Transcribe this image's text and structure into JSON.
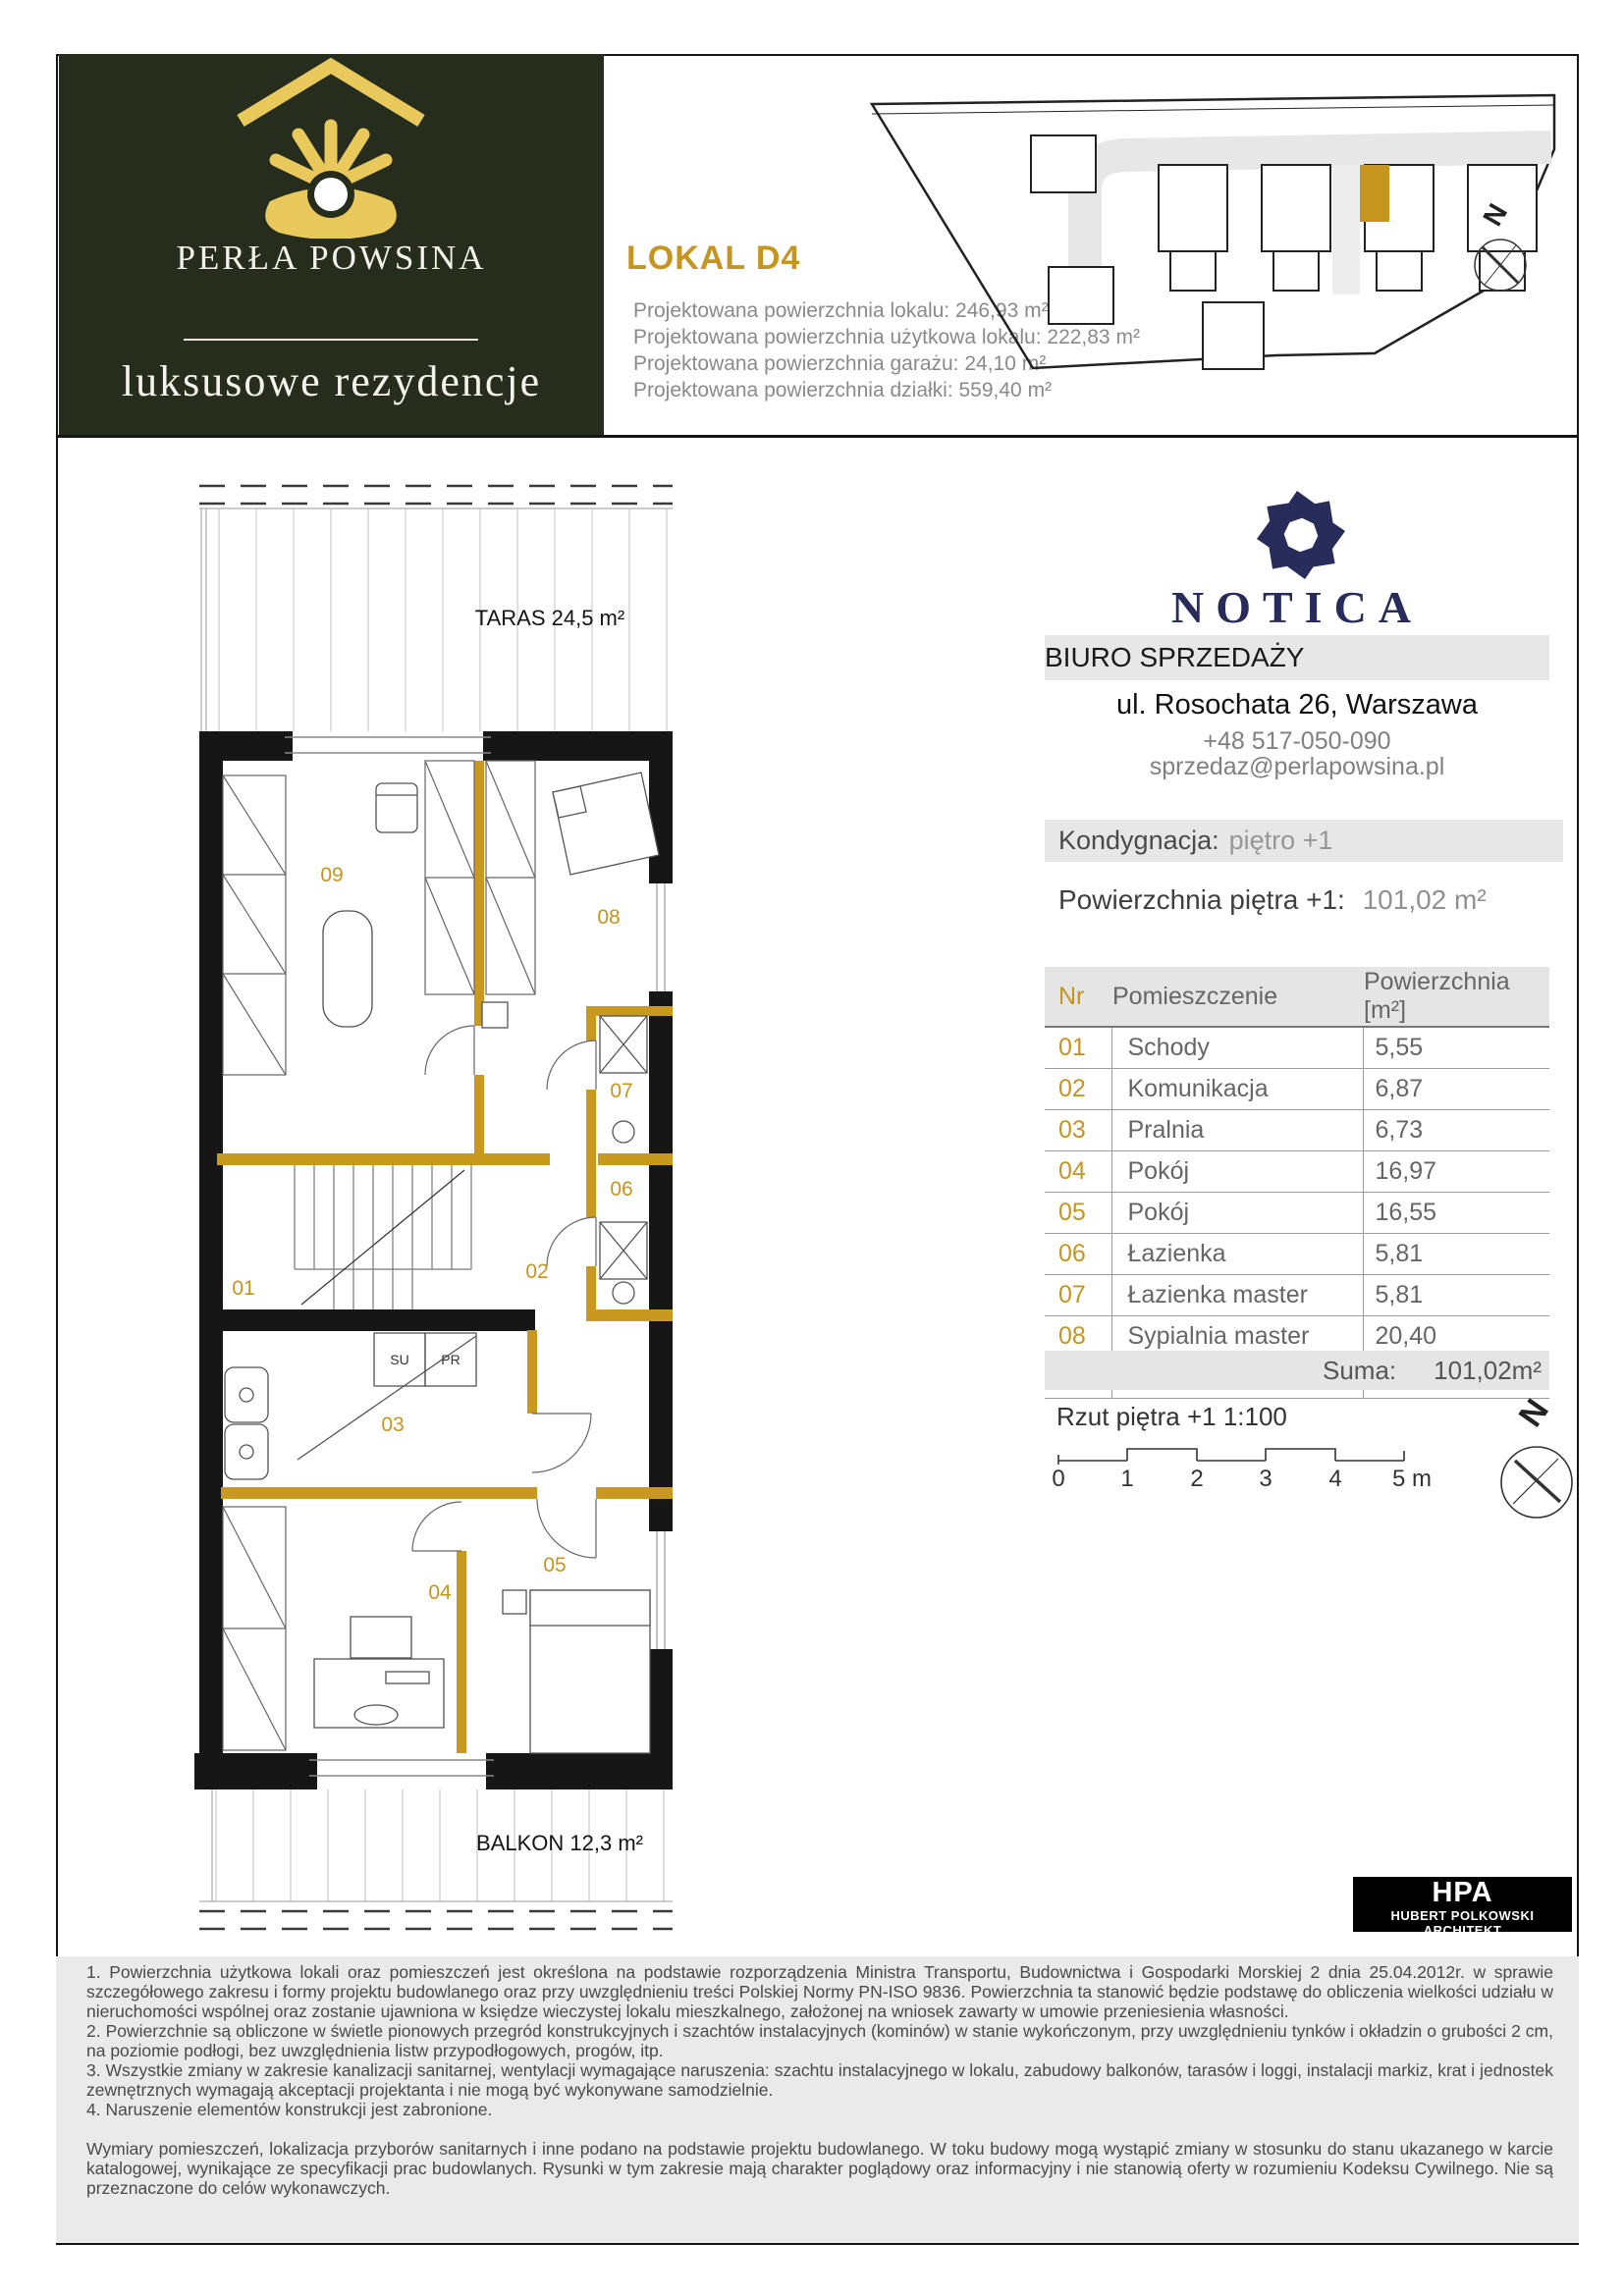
{
  "colors": {
    "accent_gold": "#C6951F",
    "brand_green": "#262D1C",
    "logo_navy": "#272C5A"
  },
  "brand": {
    "title": "PERŁA POWSINA",
    "subtitle": "luksusowe rezydencje"
  },
  "header": {
    "unit_title": "LOKAL D4",
    "specs": [
      "Projektowana powierzchnia lokalu:  246,93 m²",
      "Projektowana powierzchnia użytkowa lokalu:  222,83 m²",
      "Projektowana powierzchnia garażu:  24,10 m²",
      "Projektowana powierzchnia działki:  559,40 m²"
    ]
  },
  "site_plan": {
    "north_label": "N"
  },
  "floor_plan": {
    "terrace_label": "TARAS 24,5 m²",
    "balcony_label": "BALKON 12,3 m²",
    "rooms": [
      "01",
      "02",
      "03",
      "04",
      "05",
      "06",
      "07",
      "08",
      "09"
    ],
    "washer_label": "SU",
    "dryer_label": "PR"
  },
  "sales_office": {
    "logo_text": "NOTICA",
    "band_label": "BIURO SPRZEDAŻY",
    "address": "ul. Rosochata 26, Warszawa",
    "phone": "+48 517-050-090",
    "email": "sprzedaz@perlapowsina.pl"
  },
  "floor_info": {
    "storey_label": "Kondygnacja:",
    "storey_value": "piętro +1",
    "area_label": "Powierzchnia piętra +1:",
    "area_value": "101,02 m²"
  },
  "rooms_table": {
    "headers": {
      "nr": "Nr",
      "name": "Pomieszczenie",
      "area": "Powierzchnia [m²]"
    },
    "rows": [
      {
        "nr": "01",
        "name": "Schody",
        "area": "5,55"
      },
      {
        "nr": "02",
        "name": "Komunikacja",
        "area": "6,87"
      },
      {
        "nr": "03",
        "name": "Pralnia",
        "area": "6,73"
      },
      {
        "nr": "04",
        "name": "Pokój",
        "area": "16,97"
      },
      {
        "nr": "05",
        "name": "Pokój",
        "area": "16,55"
      },
      {
        "nr": "06",
        "name": "Łazienka",
        "area": "5,81"
      },
      {
        "nr": "07",
        "name": "Łazienka master",
        "area": "5,81"
      },
      {
        "nr": "08",
        "name": "Sypialnia master",
        "area": "20,40"
      },
      {
        "nr": "09",
        "name": "Garderoba master",
        "area": "16,33"
      }
    ],
    "sum_label": "Suma:",
    "sum_value": "101,02m²"
  },
  "scale": {
    "caption": "Rzut piętra +1 1:100",
    "ticks": [
      "0",
      "1",
      "2",
      "3",
      "4"
    ],
    "last_tick": "5 m",
    "north_label": "N"
  },
  "architect": {
    "abbr": "HPA",
    "full": "HUBERT POLKOWSKI ARCHITEKT"
  },
  "legal": {
    "clauses": [
      "1. Powierzchnia użytkowa lokali oraz pomieszczeń jest określona na podstawie rozporządzenia Ministra Transportu, Budownictwa i Gospodarki Morskiej 2 dnia 25.04.2012r. w sprawie szczegółowego zakresu i formy projektu budowlanego oraz przy uwzględnieniu treści Polskiej Normy PN-ISO 9836. Powierzchnia ta stanowić będzie podstawę do obliczenia wielkości udziału w nieruchomości wspólnej oraz zostanie ujawniona w księdze wieczystej lokalu mieszkalnego, założonej na wniosek zawarty w umowie przeniesienia własności.",
      "2. Powierzchnie są obliczone w świetle pionowych przegród konstrukcyjnych i szachtów instalacyjnych (kominów) w stanie wykończonym, przy uwzględnieniu tynków i okładzin o grubości 2 cm, na poziomie podłogi, bez uwzględnienia listw przypodłogowych, progów, itp.",
      "3. Wszystkie zmiany w zakresie kanalizacji sanitarnej, wentylacji wymagające naruszenia: szachtu instalacyjnego w lokalu, zabudowy balkonów, tarasów i loggi, instalacji markiz, krat i jednostek zewnętrznych wymagają akceptacji projektanta i nie mogą być wykonywane samodzielnie.",
      "4. Naruszenie elementów konstrukcji jest zabronione."
    ],
    "footer": "Wymiary pomieszczeń, lokalizacja przyborów sanitarnych i inne podano na podstawie projektu budowlanego. W toku budowy mogą wystąpić zmiany w stosunku do stanu ukazanego w karcie katalogowej, wynikające ze specyfikacji prac budowlanych. Rysunki w tym zakresie mają charakter poglądowy oraz informacyjny i nie stanowią oferty w rozumieniu Kodeksu Cywilnego. Nie są przeznaczone do celów wykonawczych."
  }
}
